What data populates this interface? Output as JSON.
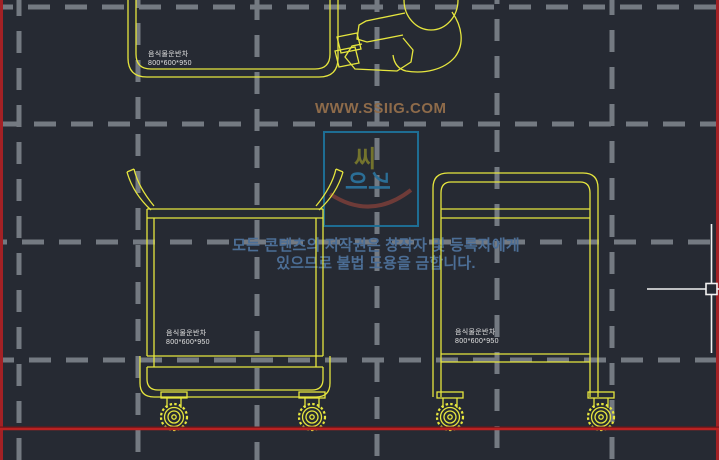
{
  "viewport": {
    "background_color": "#262a33",
    "grid_color": "#747a82",
    "drawing_color": "#e6e63e",
    "sheet_border_color": "#b92222",
    "crosshair_color": "#f1f1f1"
  },
  "watermark": {
    "text": "WWW.SSIIG.COM",
    "color": "#8e6b4a"
  },
  "stamp_logo": {
    "top_char": "씨",
    "side_char_1": "이",
    "side_char_2": "기",
    "frame_color": "#1e6d93",
    "top_char_color": "#73732d",
    "side_char_color": "#2b6e96",
    "smile_color": "#6e3b38"
  },
  "copyright_notice": {
    "line1": "모든 콘텐츠의 저작권은 창작자 및 등록자에게",
    "line2": "있으므로 불법 도용을 금합니다.",
    "color": "#4c6e96"
  },
  "drawings": {
    "plan_view_cart": {
      "label_name": "음식물운반차",
      "label_size": "800*600*950"
    },
    "front_view_cart": {
      "label_name": "음식물운반차",
      "label_size": "800*600*950"
    },
    "side_view_cart": {
      "label_name": "음식물운반차",
      "label_size": "800*600*950"
    }
  }
}
